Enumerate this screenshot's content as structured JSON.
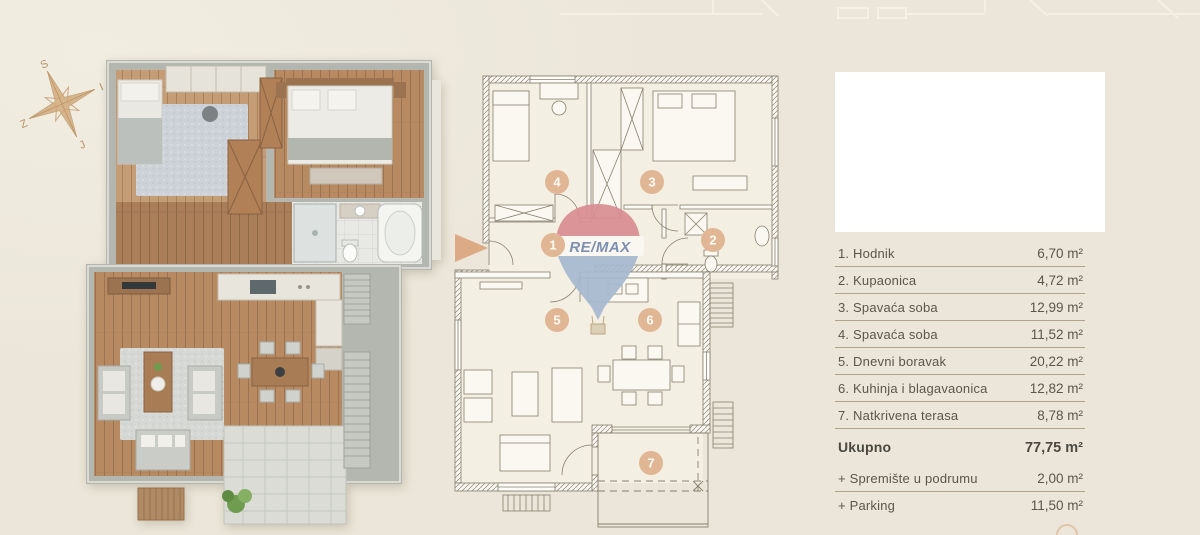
{
  "page": {
    "background": "#ece7db"
  },
  "compass": {
    "n": "S",
    "e": "I",
    "s": "J",
    "w": "Z"
  },
  "plan2d": {
    "balloon_text": "RE/MAX",
    "rooms": [
      {
        "number": "1"
      },
      {
        "number": "2"
      },
      {
        "number": "3"
      },
      {
        "number": "4"
      },
      {
        "number": "5"
      },
      {
        "number": "6"
      },
      {
        "number": "7"
      }
    ]
  },
  "legend": {
    "rows": [
      {
        "label": "1. Hodnik",
        "value": "6,70 m²"
      },
      {
        "label": "2. Kupaonica",
        "value": "4,72 m²"
      },
      {
        "label": "3. Spavaća soba",
        "value": "12,99 m²"
      },
      {
        "label": "4. Spavaća soba",
        "value": "11,52 m²"
      },
      {
        "label": "5. Dnevni boravak",
        "value": "20,22 m²"
      },
      {
        "label": "6. Kuhinja i blagavaonica",
        "value": "12,82 m²"
      },
      {
        "label": "7. Natkrivena terasa",
        "value": "8,78 m²"
      }
    ],
    "total": {
      "label": "Ukupno",
      "value": "77,75 m²"
    },
    "extras": [
      {
        "label": "+ Spremište u podrumu",
        "value": "2,00 m²"
      },
      {
        "label": "+ Parking",
        "value": "11,50 m²"
      }
    ]
  },
  "colors": {
    "badge": "#e1b694",
    "arrow": "#dcaa84",
    "balloon_red": "#d98e93",
    "balloon_blue": "#a6b9d0",
    "balloon_text": "#7388ad",
    "legend_line": "#b1a28a",
    "text": "#5a564b"
  }
}
